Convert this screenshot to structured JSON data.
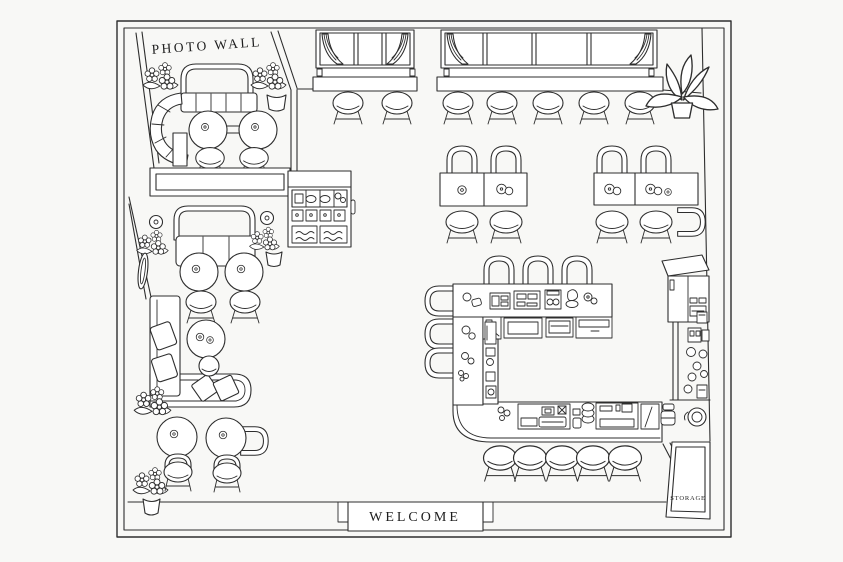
{
  "colors": {
    "background": "#f8f8f6",
    "line": "#2e2e2e",
    "text": "#1e1e1e"
  },
  "labels": {
    "photo_wall": "PHOTO WALL",
    "welcome": "WELCOME",
    "storage": "STORAGE"
  },
  "plan": {
    "type": "cafe-restaurant-floor-plan",
    "style": "hand-drawn line art, top view",
    "areas": [
      {
        "name": "photo-wall-booth",
        "label": "PHOTO WALL",
        "furniture": [
          "curved booth sofa",
          "arched bench back",
          "2 round tables",
          "2 stools",
          "flower decor",
          "potted plant"
        ]
      },
      {
        "name": "window-bar",
        "furniture": [
          "2 multi-pane windows with curtains",
          "window counter",
          "7 bar stools"
        ]
      },
      {
        "name": "dining-area",
        "furniture": [
          "2 double-table groups",
          "9 chairs",
          "table settings"
        ]
      },
      {
        "name": "pastry-display-station",
        "furniture": [
          "display case with pastries",
          "service counter"
        ]
      },
      {
        "name": "lounge",
        "furniture": [
          "arched loveseat",
          "2 wall lamps",
          "2 round tables",
          "2 stools",
          "wall mirror",
          "L-shaped sofa",
          "throw pillows",
          "coffee table",
          "ottoman"
        ]
      },
      {
        "name": "cafe-corner",
        "furniture": [
          "2 round tables",
          "3 chairs",
          "2 potted plants"
        ]
      },
      {
        "name": "kitchen-island",
        "furniture": [
          "U-shaped counter",
          "espresso machine",
          "cash register",
          "grinder",
          "appliance shelf",
          "3 counter chairs",
          "3 side chairs",
          "5 bar stools"
        ]
      },
      {
        "name": "back-station",
        "furniture": [
          "refrigerator",
          "wall counter with jars",
          "round grinder"
        ]
      },
      {
        "name": "storage-room",
        "label": "STORAGE"
      },
      {
        "name": "entrance",
        "label": "WELCOME",
        "furniture": [
          "doormat"
        ]
      }
    ],
    "counts": {
      "window_bar_stools": 7,
      "island_stools": 5,
      "island_counter_chairs": 3,
      "island_side_chairs": 3,
      "dining_chairs": 9,
      "round_tables": 7,
      "potted_plants": 5,
      "flower_clusters": 6,
      "windows": 2,
      "curtains": 4
    }
  }
}
